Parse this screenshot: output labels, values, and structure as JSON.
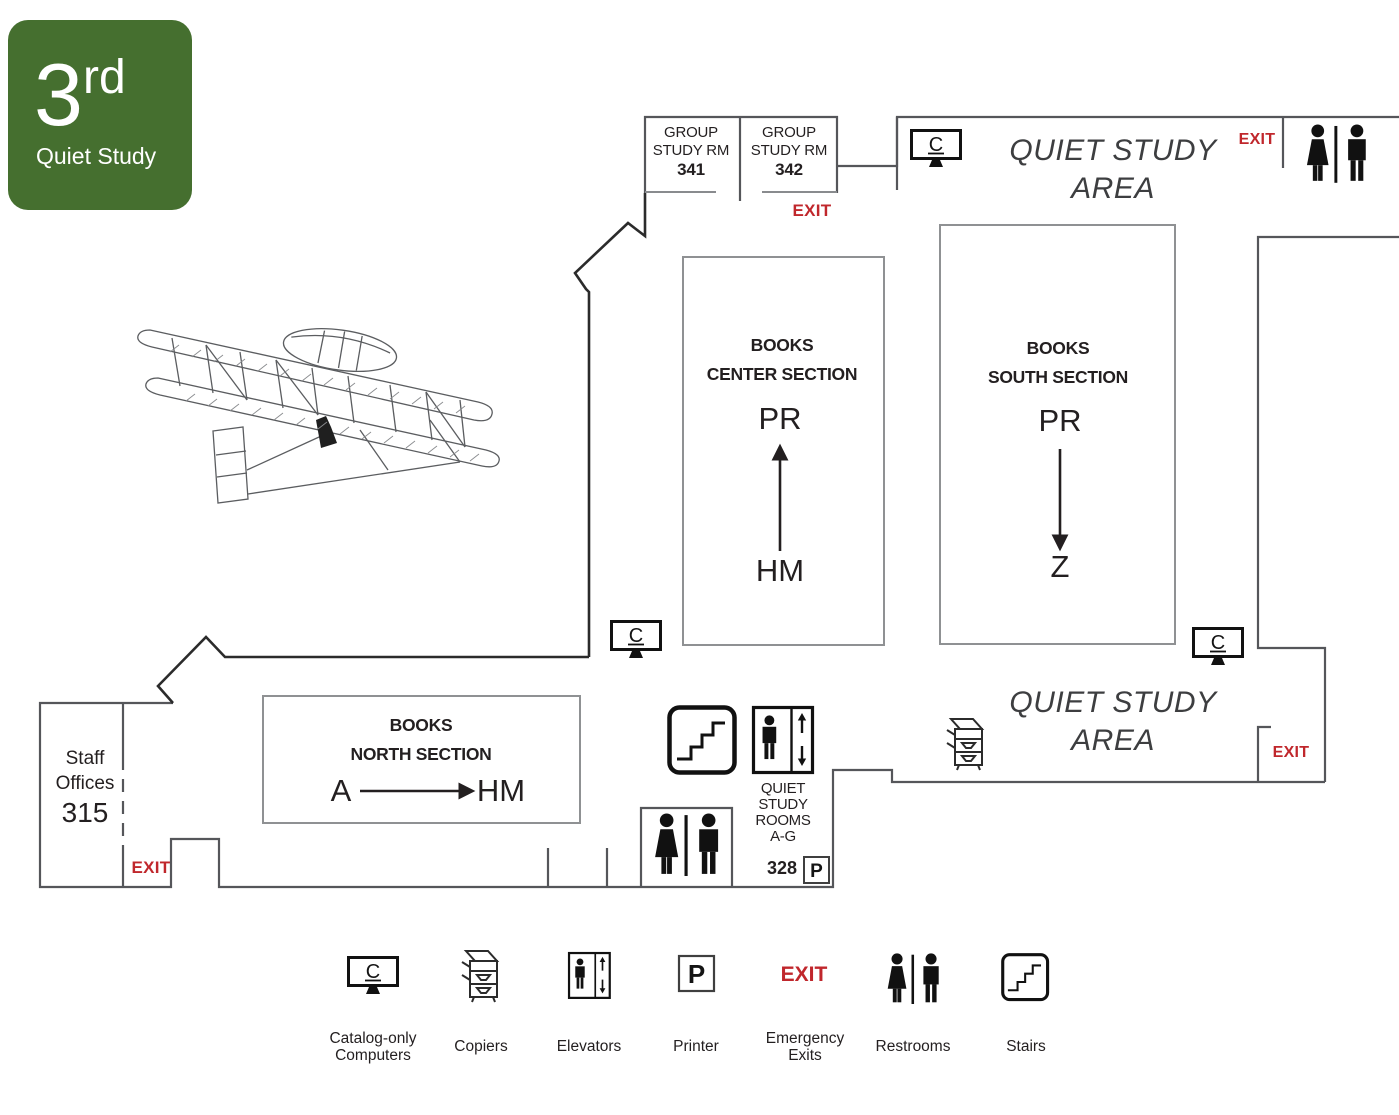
{
  "badge": {
    "floor_number": "3",
    "floor_suffix": "rd",
    "label": "Quiet Study"
  },
  "colors": {
    "badge_green": "#456f2f",
    "exit_red": "#c0272c",
    "wall_gray": "#55565a",
    "wall_dark": "#2b2b2b",
    "box_border_gray": "#8f9193",
    "text_dark": "#231f20"
  },
  "rooms": {
    "group_341": {
      "line1": "GROUP",
      "line2": "STUDY RM",
      "number": "341"
    },
    "group_342": {
      "line1": "GROUP",
      "line2": "STUDY RM",
      "number": "342"
    },
    "books_center": {
      "line1": "BOOKS",
      "line2": "CENTER SECTION",
      "range_end": "PR",
      "range_start": "HM"
    },
    "books_south": {
      "line1": "BOOKS",
      "line2": "SOUTH SECTION",
      "range_start": "PR",
      "range_end": "Z"
    },
    "books_north": {
      "line1": "BOOKS",
      "line2": "NORTH SECTION",
      "range_start": "A",
      "range_end": "HM"
    },
    "staff_offices": {
      "line1": "Staff",
      "line2": "Offices",
      "number": "315"
    },
    "quiet_study_top": {
      "line1": "QUIET STUDY",
      "line2": "AREA"
    },
    "quiet_study_bottom": {
      "line1": "QUIET STUDY",
      "line2": "AREA"
    },
    "quiet_rooms": {
      "line1": "QUIET",
      "line2": "STUDY",
      "line3": "ROOMS",
      "line4": "A-G",
      "number": "328"
    }
  },
  "exits": {
    "top": "EXIT",
    "top_right": "EXIT",
    "bottom_left": "EXIT",
    "bottom_right": "EXIT"
  },
  "icons": {
    "catalog_letter": "C",
    "printer_letter": "P"
  },
  "legend": {
    "exit_symbol": "EXIT",
    "items": [
      {
        "icon": "catalog-computer-icon",
        "label": "Catalog-only Computers"
      },
      {
        "icon": "copier-icon",
        "label": "Copiers"
      },
      {
        "icon": "elevator-icon",
        "label": "Elevators"
      },
      {
        "icon": "printer-icon",
        "label": "Printer"
      },
      {
        "icon": "emergency-exit-icon",
        "label": "Emergency Exits"
      },
      {
        "icon": "restrooms-icon",
        "label": "Restrooms"
      },
      {
        "icon": "stairs-icon",
        "label": "Stairs"
      }
    ]
  }
}
